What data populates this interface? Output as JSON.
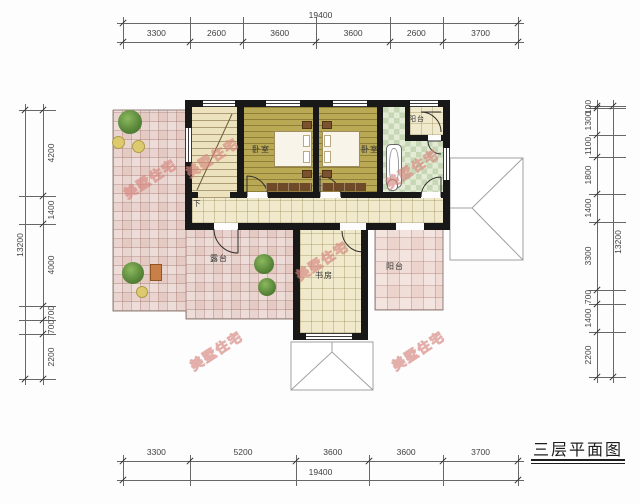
{
  "title": {
    "text": "三层平面图"
  },
  "watermark": {
    "text": "美墅住宅"
  },
  "rooms": {
    "bedroom_left": {
      "label": "卧室"
    },
    "bedroom_right": {
      "label": "卧室"
    },
    "balcony_top": {
      "label": "阳台"
    },
    "balcony_right": {
      "label": "阳台"
    },
    "terrace": {
      "label": "露台"
    },
    "study": {
      "label": "书房"
    },
    "stairs_down": {
      "label": "下"
    }
  },
  "dimensions": {
    "top": {
      "total": "19400",
      "segments": [
        "3300",
        "2600",
        "3600",
        "3600",
        "2600",
        "3700"
      ]
    },
    "bottom": {
      "total": "19400",
      "segments": [
        "3300",
        "5200",
        "3600",
        "3600",
        "3700"
      ]
    },
    "left": {
      "total": "13200",
      "segments": [
        "4200",
        "1400",
        "4000",
        "700",
        "700",
        "2200"
      ]
    },
    "right": {
      "total": "13200",
      "segments": [
        "100",
        "1300",
        "1100",
        "1800",
        "1400",
        "3300",
        "700",
        "1400",
        "2200"
      ]
    }
  },
  "colors": {
    "wall": "#181818",
    "terrace_tile": "#e4cac3",
    "balcony_tile": "#ecd4cc",
    "wood_floor": "#b9a954",
    "tile_cream": "#f0e9cb",
    "bath_tile": "#c7d7b6",
    "roof_line": "#a0a0a0",
    "watermark_pink": "#d07670",
    "dim_text": "#3f3f3f"
  }
}
